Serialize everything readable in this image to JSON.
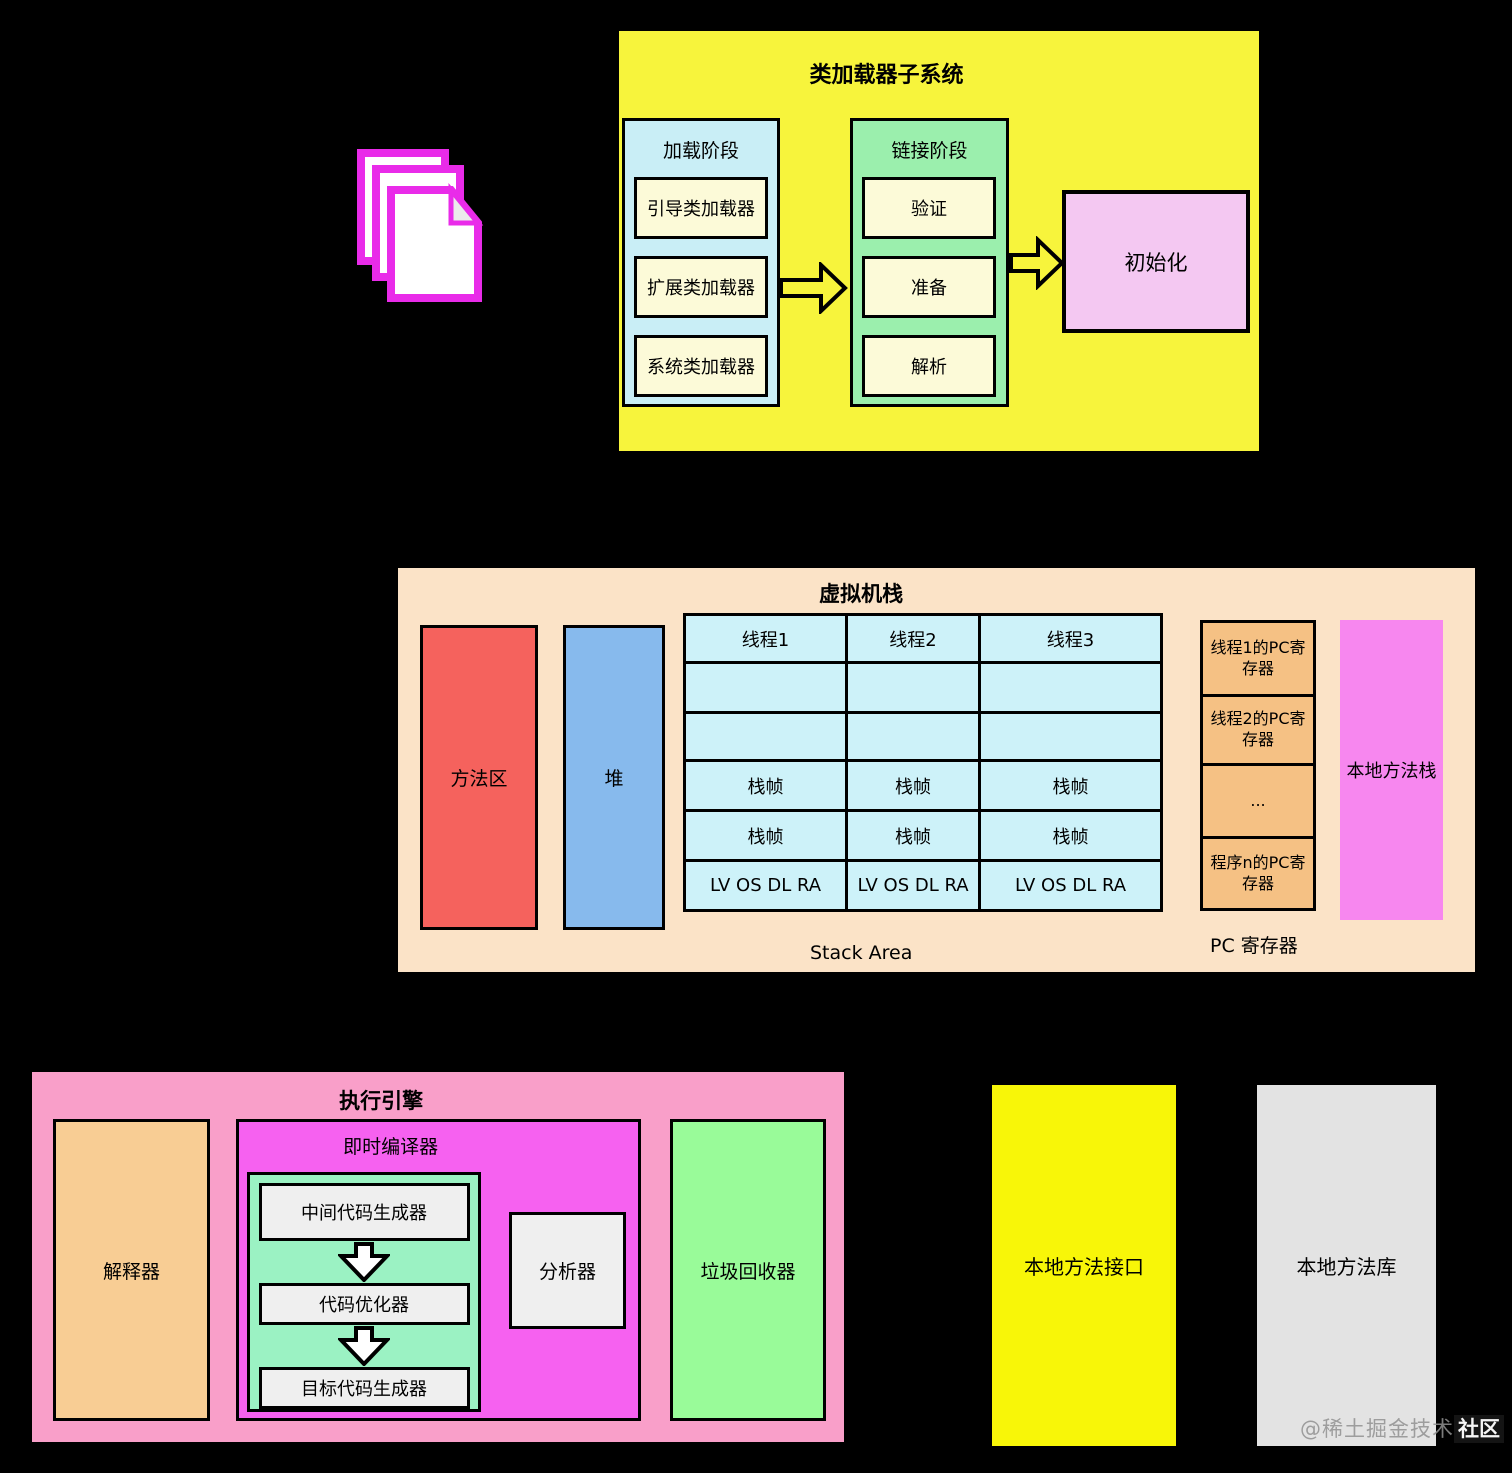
{
  "colors": {
    "background": "#000000",
    "class_loader_bg": "#F7F43C",
    "loading_bg": "#C9EEF6",
    "loader_item_bg": "#FCFAD8",
    "linking_bg": "#9BEFAD",
    "init_bg": "#F4C8F2",
    "runtime_bg": "#FBE3C7",
    "method_area_bg": "#F5625D",
    "heap_bg": "#87BAED",
    "stack_cell_bg": "#CDF2F9",
    "pc_cell_bg": "#F5C184",
    "native_stack_bg": "#F787EF",
    "engine_bg": "#F99FC9",
    "interpreter_bg": "#F8CD94",
    "jit_bg": "#F661F0",
    "jit_inner_bg": "#9BF2C3",
    "pipeline_box_bg": "#EFEFEF",
    "gc_bg": "#99FB99",
    "native_interface_bg": "#F8F608",
    "native_library_bg": "#E3E3E3",
    "doc_icon_stroke": "#E92BE9"
  },
  "class_loader": {
    "title": "类加载器子系统",
    "loading": {
      "title": "加载阶段",
      "items": [
        "引导类加载器",
        "扩展类加载器",
        "系统类加载器"
      ]
    },
    "linking": {
      "title": "链接阶段",
      "items": [
        "验证",
        "准备",
        "解析"
      ]
    },
    "init_label": "初始化"
  },
  "vm": {
    "title": "虚拟机栈",
    "method_area_label": "方法区",
    "heap_label": "堆",
    "table": {
      "rows": [
        [
          "线程1",
          "线程2",
          "线程3"
        ],
        [
          "",
          "",
          ""
        ],
        [
          "",
          "",
          ""
        ],
        [
          "栈帧",
          "栈帧",
          "栈帧"
        ],
        [
          "栈帧",
          "栈帧",
          "栈帧"
        ],
        [
          "LV OS DL RA",
          "LV OS DL RA",
          "LV OS DL RA"
        ]
      ]
    },
    "stack_area_label": "Stack Area",
    "pc": {
      "cells": [
        "线程1的PC寄存器",
        "线程2的PC寄存器",
        "...",
        "程序n的PC寄存器"
      ],
      "caption": "PC 寄存器"
    },
    "native_stack_label": "本地方法栈"
  },
  "engine": {
    "title": "执行引擎",
    "interpreter_label": "解释器",
    "jit": {
      "title": "即时编译器",
      "pipeline": [
        "中间代码生成器",
        "代码优化器",
        "目标代码生成器"
      ],
      "profiler_label": "分析器"
    },
    "gc_label": "垃圾回收器"
  },
  "native_interface_label": "本地方法接口",
  "native_library_label": "本地方法库",
  "watermark": {
    "prefix": "@稀土掘金技术",
    "suffix": "社区"
  }
}
